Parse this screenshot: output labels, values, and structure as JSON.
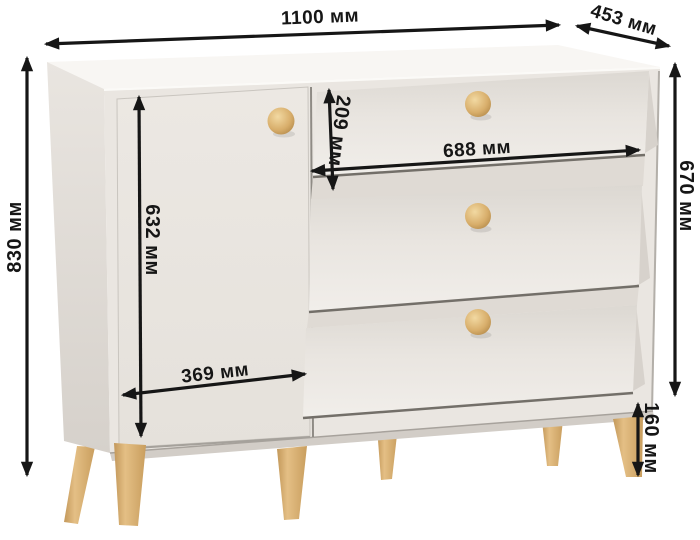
{
  "diagram": {
    "subject": "chest-of-drawers-dimension-diagram",
    "unit": "мм"
  },
  "labels": {
    "width_total": "1100 мм",
    "depth": "453 мм",
    "height_total": "830 мм",
    "height_body": "670 мм",
    "door_height": "632 мм",
    "top_drawer_height": "209 мм",
    "drawer_width": "688 мм",
    "door_width": "369 мм",
    "leg_height": "160 мм"
  },
  "colors": {
    "background": "#ffffff",
    "dimension_line": "#161616",
    "label_text": "#161616",
    "cabinet_front": "#eae6e1",
    "cabinet_top": "#f8f6f3",
    "cabinet_side": "#e3dfda",
    "shadow_line": "#736f69",
    "wood_leg": "#d5a967",
    "wood_knob": "#dcb271"
  }
}
